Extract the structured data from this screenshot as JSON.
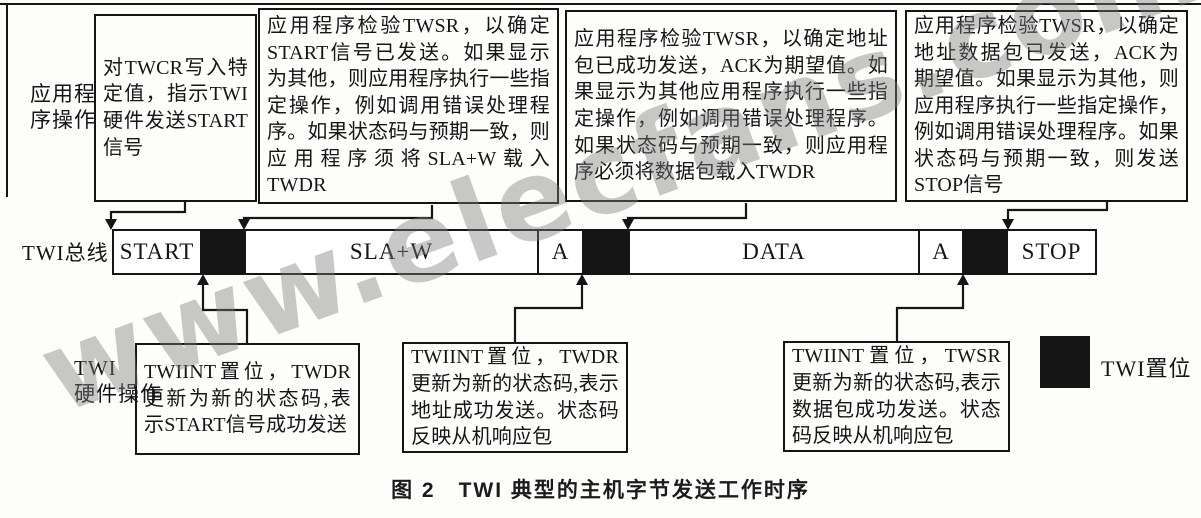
{
  "figure": {
    "caption": "图 2　TWI 典型的主机字节发送工作时序",
    "watermark": "www.elecfans.com"
  },
  "row_labels": {
    "app_line1": "应用程",
    "app_line2": "序操作",
    "bus": "TWI总线",
    "hw_line1": "TWI",
    "hw_line2": "硬件操作"
  },
  "app_boxes": [
    {
      "text": "对TWCR写入特定值，指示TWI硬件发送START信号"
    },
    {
      "text": "应用程序检验TWSR，以确定START信号已发送。如果显示为其他，则应用程序执行一些指定操作，例如调用错误处理程序。如果状态码与预期一致，则应用程序须将SLA+W载入TWDR"
    },
    {
      "text": "应用程序检验TWSR，以确定地址包已成功发送，ACK为期望值。如果显示为其他应用程序执行一些指定操作，例如调用错误处理程序。如果状态码与预期一致，则应用程序必须将数据包载入TWDR"
    },
    {
      "text": "应用程序检验TWSR，以确定地址数据包已发送，ACK为期望值。如果显示为其他，则应用程序执行一些指定操作，例如调用错误处理程序。如果状态码与预期一致，则发送STOP信号"
    }
  ],
  "bus": {
    "segments": [
      {
        "label": "START",
        "type": "signal"
      },
      {
        "label": "",
        "type": "twi-set"
      },
      {
        "label": "SLA+W",
        "type": "signal"
      },
      {
        "label": "A",
        "type": "signal"
      },
      {
        "label": "",
        "type": "twi-set"
      },
      {
        "label": "DATA",
        "type": "signal"
      },
      {
        "label": "A",
        "type": "signal"
      },
      {
        "label": "",
        "type": "twi-set"
      },
      {
        "label": "STOP",
        "type": "signal"
      }
    ]
  },
  "hw_boxes": [
    {
      "text": "TWIINT置位，TWDR更新为新的状态码,表示START信号成功发送"
    },
    {
      "text": "TWIINT置位，TWDR更新为新的状态码,表示地址成功发送。状态码反映从机响应包"
    },
    {
      "text": "TWIINT置位，TWSR更新为新的状态码,表示数据包成功发送。状态码反映从机响应包"
    }
  ],
  "legend": {
    "label": "TWI置位",
    "swatch_color": "#151515"
  },
  "colors": {
    "ink": "#151515",
    "paper": "#fdfdfc",
    "watermark_gray": "#7d7d7d"
  }
}
